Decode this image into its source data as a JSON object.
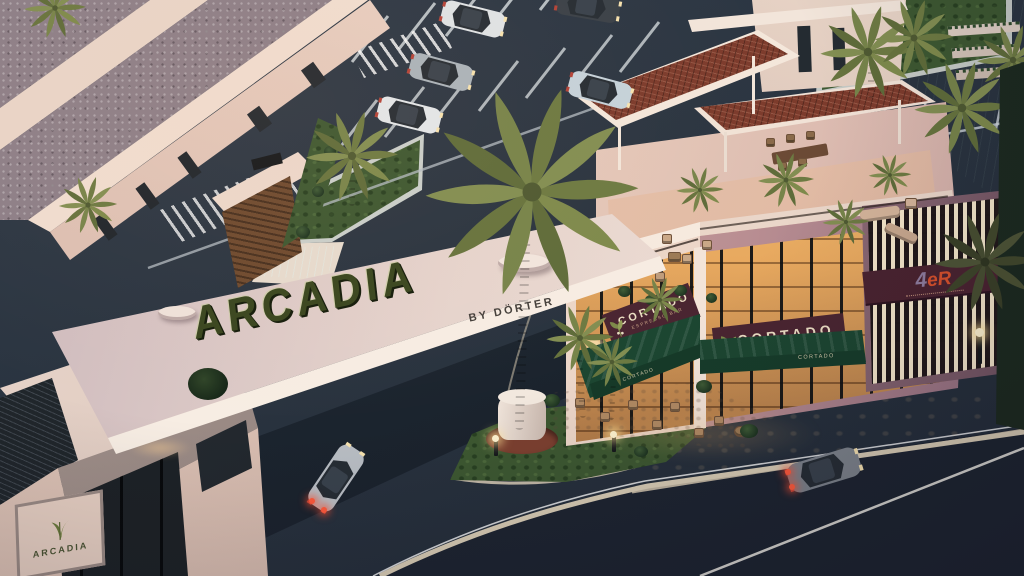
{
  "gate": {
    "main_sign": "ARCADIA",
    "sub_sign": "BY DÖRTER"
  },
  "gatehouse": {
    "sign_text": "ARCADIA"
  },
  "cafe": {
    "name": "CORTADO",
    "tagline": "ESPRESSO BAR",
    "awning_text": "CORTADO"
  },
  "shop": {
    "sign_4": "4",
    "sign_er": "eR"
  },
  "icons": {
    "gatehouse_logo": "palm-leaf-icon",
    "cafe_logo": "coffee-branch-icon"
  },
  "colors": {
    "gate_letters_green": "#333f1f",
    "cafe_sign_maroon": "#4a2531",
    "cafe_sign_text": "#ecdfc4",
    "awning_green": "#1c4631",
    "shop_er_orange": "#d8512c",
    "window_glow": "#f0b66a",
    "asphalt": "#2a3440",
    "grass": "#3d5831",
    "terracotta_roof": "#7c3b2c",
    "canal_green": "#163020"
  }
}
